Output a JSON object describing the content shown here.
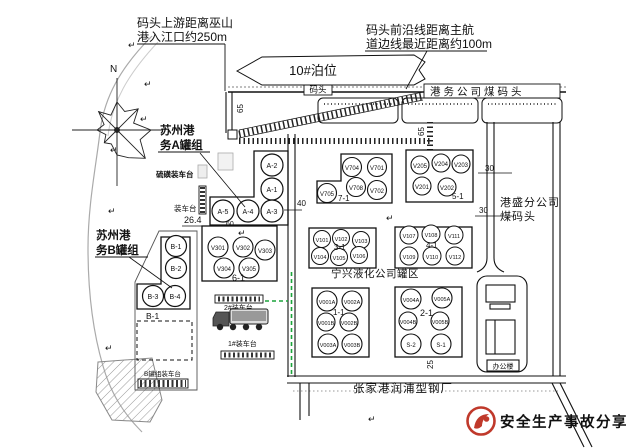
{
  "notes": {
    "upstream": [
      "码头上游距离巫山",
      "港入江口约250m"
    ],
    "channel": [
      "码头前沿线距离主航",
      "道边线最近距离约100m"
    ]
  },
  "berth_label": "10#泊位",
  "wharf": {
    "dock": "码头",
    "coal_dock": "港务公司煤码头"
  },
  "gangsheng": [
    "港盛分公司",
    "煤码头"
  ],
  "office": "办公楼",
  "north": "N",
  "groups": {
    "a": {
      "title": [
        "苏州港",
        "务A罐组"
      ],
      "tanks": [
        "A-2",
        "A-1",
        "A-5",
        "A-4",
        "A-3"
      ]
    },
    "b": {
      "title": [
        "苏州港",
        "务B罐组"
      ],
      "tanks": [
        "B-1",
        "B-2",
        "B-3",
        "B-4"
      ],
      "area": "B-1"
    },
    "g61": {
      "label": "6-1",
      "tanks": [
        "V301",
        "V302",
        "V303",
        "V304",
        "V305"
      ]
    },
    "g71": {
      "label": "7-1",
      "tanks": [
        "V704",
        "V701",
        "V708",
        "V702",
        "V705"
      ]
    },
    "g51": {
      "label": "5-1",
      "tanks": [
        "V205",
        "V204",
        "V203",
        "V201",
        "V202"
      ]
    },
    "g31": {
      "label": "3-1",
      "tanks": [
        "V101",
        "V102",
        "V103",
        "V104",
        "V105",
        "V106"
      ]
    },
    "g41": {
      "label": "4-1",
      "tanks": [
        "V107",
        "V108",
        "V111",
        "V109",
        "V110",
        "V112"
      ]
    },
    "g11": {
      "label": "1-1",
      "tanks": [
        "V001A",
        "V002A",
        "V001B",
        "V002B",
        "V003A",
        "V003B"
      ]
    },
    "g21": {
      "label": "2-1",
      "tanks": [
        "V004A",
        "V005A",
        "V004B",
        "V005B",
        "S-2",
        "S-1"
      ]
    }
  },
  "platforms": {
    "sulfur": "硫磺装车台",
    "loading": "装车台",
    "b_loading": "B罐组装车台",
    "p2": "2#装车台",
    "p1": "1#装车台"
  },
  "areas": {
    "ningxing": "宁兴液化公司罐区",
    "steel_plant": "张家港润浦型钢厂"
  },
  "dims": {
    "d65_left": "65",
    "d65_right": "65",
    "d40": "40",
    "d26_4": "26.4",
    "d60": "60",
    "d30_top": "30",
    "d30_bottom": "30",
    "d25": "25"
  },
  "footer": {
    "brand": "安全生产事故分享",
    "brand_color": "#c0392b"
  },
  "glyphs": {
    "return": "↵"
  }
}
